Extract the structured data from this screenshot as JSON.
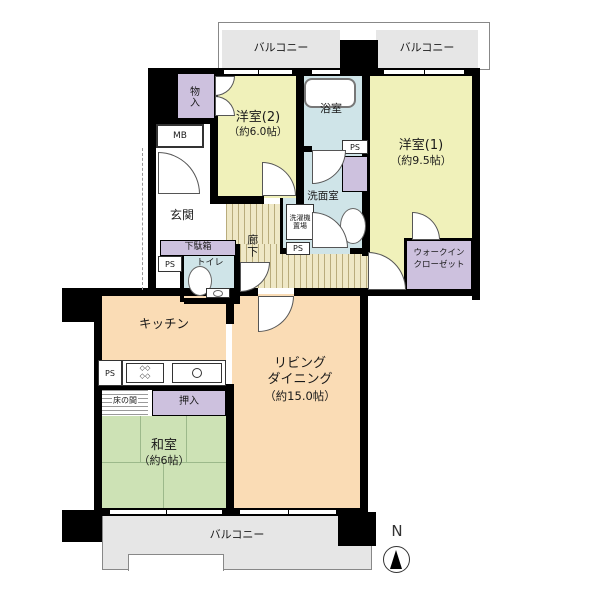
{
  "plan": {
    "balconies": {
      "top_left": "バルコニー",
      "top_right": "バルコニー",
      "bottom": "バルコニー"
    },
    "rooms": {
      "western2": {
        "name": "洋室(2)",
        "size": "（約6.0帖）"
      },
      "western1": {
        "name": "洋室(1)",
        "size": "（約9.5帖）"
      },
      "washitsu": {
        "name": "和室",
        "size": "（約6帖）"
      },
      "living": {
        "name_line1": "リビング",
        "name_line2": "ダイニング",
        "size": "（約15.0帖）"
      },
      "kitchen": {
        "name": "キッチン"
      },
      "bath": {
        "name": "浴室"
      },
      "washroom": {
        "name": "洗面室"
      },
      "toilet": {
        "name": "トイレ"
      },
      "genkan": {
        "name": "玄関"
      },
      "corridor": {
        "name": "廊下"
      },
      "wic": {
        "line1": "ウォークイン",
        "line2": "クローゼット"
      }
    },
    "features": {
      "storage": "物入",
      "mb": "MB",
      "ps": "PS",
      "getabako": "下駄箱",
      "laundry_line1": "洗濯機",
      "laundry_line2": "置場",
      "oshiire": "押入",
      "tokonoma": "床の間"
    },
    "compass": {
      "north": "N"
    },
    "colors": {
      "wall": "#000000",
      "room_yellow": "#f0f1ba",
      "room_orange": "#fadcb5",
      "room_green": "#cde2b5",
      "room_purple": "#cdc1de",
      "room_blue": "#cfe4e8",
      "corridor_base": "#efe8c6",
      "corridor_stripe": "#b9ac7c",
      "balcony_gray": "#e6e6e6"
    }
  }
}
